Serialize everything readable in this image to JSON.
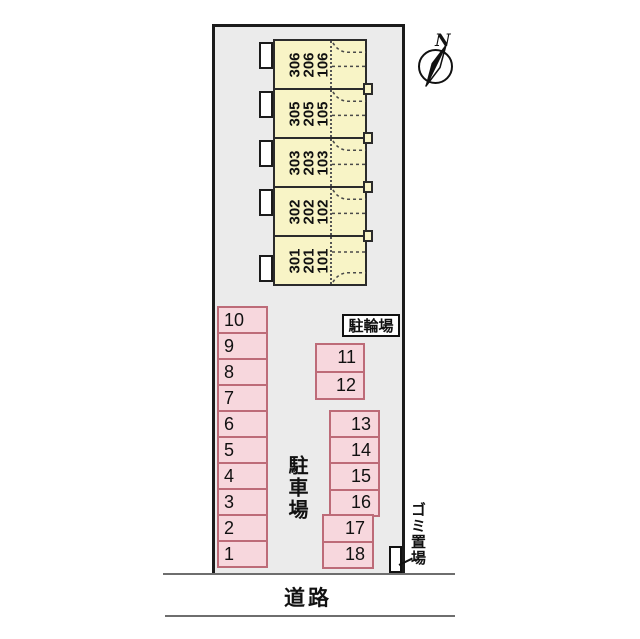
{
  "labels": {
    "bicycle_parking": "駐輪場",
    "car_parking": "駐車場",
    "garbage_area": "ゴミ置場",
    "road": "道路",
    "compass_north": "N"
  },
  "building": {
    "units": [
      {
        "floors": [
          "306",
          "206",
          "106"
        ]
      },
      {
        "floors": [
          "305",
          "205",
          "105"
        ]
      },
      {
        "floors": [
          "303",
          "203",
          "103"
        ]
      },
      {
        "floors": [
          "302",
          "202",
          "102"
        ]
      },
      {
        "floors": [
          "301",
          "201",
          "101"
        ]
      }
    ]
  },
  "parking": {
    "left_column": [
      "10",
      "9",
      "8",
      "7",
      "6",
      "5",
      "4",
      "3",
      "2",
      "1"
    ],
    "block_a": [
      "11",
      "12"
    ],
    "block_b": [
      "13",
      "14",
      "15",
      "16"
    ],
    "block_c": [
      "17",
      "18"
    ]
  },
  "colors": {
    "site_fill": "#ebebeb",
    "building_fill": "#f8f4c6",
    "building_border": "#2b2b2b",
    "parking_fill": "#f7d7dd",
    "parking_border": "#bd6b78",
    "outline": "#111111",
    "road_line": "#6e6e6e"
  }
}
